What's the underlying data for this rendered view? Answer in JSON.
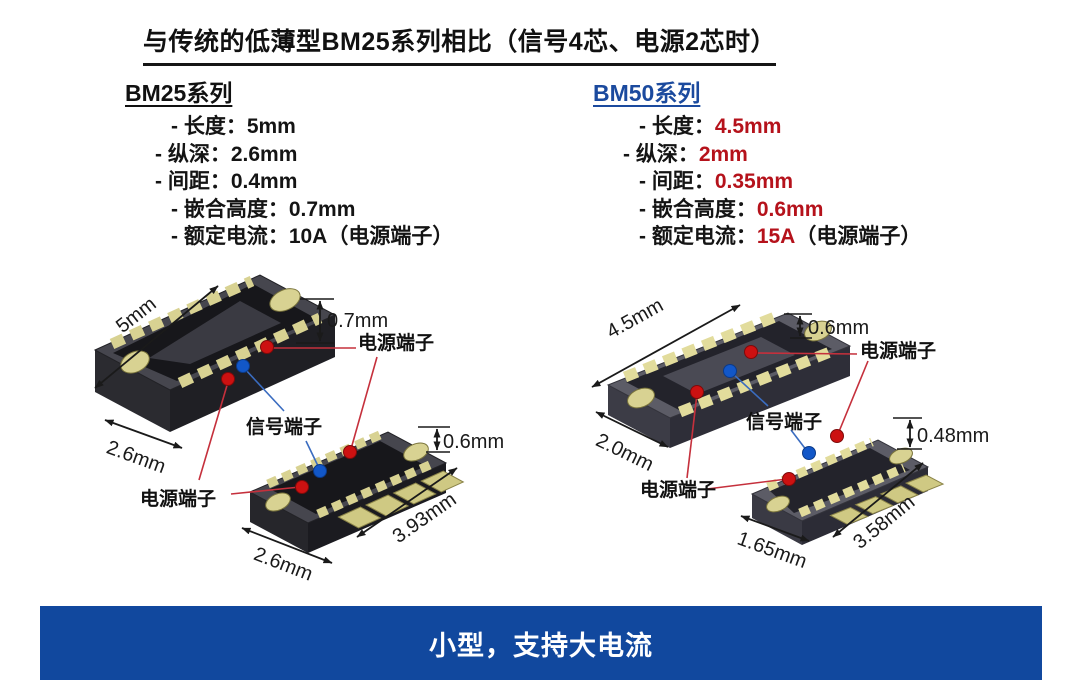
{
  "title": "与传统的低薄型BM25系列相比（信号4芯、电源2芯时）",
  "series_left": {
    "heading": "BM25系列",
    "specs": [
      {
        "label": "- 长度：",
        "value": "5mm",
        "suffix": ""
      },
      {
        "label": "- 纵深：",
        "value": "2.6mm",
        "suffix": ""
      },
      {
        "label": "- 间距：",
        "value": "0.4mm",
        "suffix": ""
      },
      {
        "label": "- 嵌合高度：",
        "value": "0.7mm",
        "suffix": ""
      },
      {
        "label": "- 额定电流：",
        "value": "10A",
        "suffix": "（电源端子）"
      }
    ]
  },
  "series_right": {
    "heading": "BM50系列",
    "specs": [
      {
        "label": "- 长度：",
        "value": "4.5mm",
        "suffix": ""
      },
      {
        "label": "- 纵深：",
        "value": "2mm",
        "suffix": ""
      },
      {
        "label": "- 间距：",
        "value": "0.35mm",
        "suffix": ""
      },
      {
        "label": "- 嵌合高度：",
        "value": "0.6mm",
        "suffix": ""
      },
      {
        "label": "- 额定电流：",
        "value": "15A",
        "suffix": "（电源端子）"
      }
    ]
  },
  "diagram_left": {
    "dim_length": "5mm",
    "dim_depth": "2.6mm",
    "dim_height": "0.7mm",
    "dim_plug_height": "0.6mm",
    "dim_plug_diag": "3.93mm",
    "dim_plug_depth": "2.6mm",
    "label_power_top": "电源端子",
    "label_signal": "信号端子",
    "label_power_bottom": "电源端子"
  },
  "diagram_right": {
    "dim_length": "4.5mm",
    "dim_depth": "2.0mm",
    "dim_height": "0.6mm",
    "dim_plug_height": "0.48mm",
    "dim_plug_diag": "3.58mm",
    "dim_plug_depth": "1.65mm",
    "label_power_top": "电源端子",
    "label_signal": "信号端子",
    "label_power_bottom": "电源端子"
  },
  "banner": {
    "text": "小型，支持大电流"
  },
  "colors": {
    "accent_blue": "#1b4a9e",
    "highlight_red": "#b5121b",
    "banner_blue": "#11489e",
    "power_dot": "#cc1111",
    "signal_dot": "#1257c8"
  }
}
